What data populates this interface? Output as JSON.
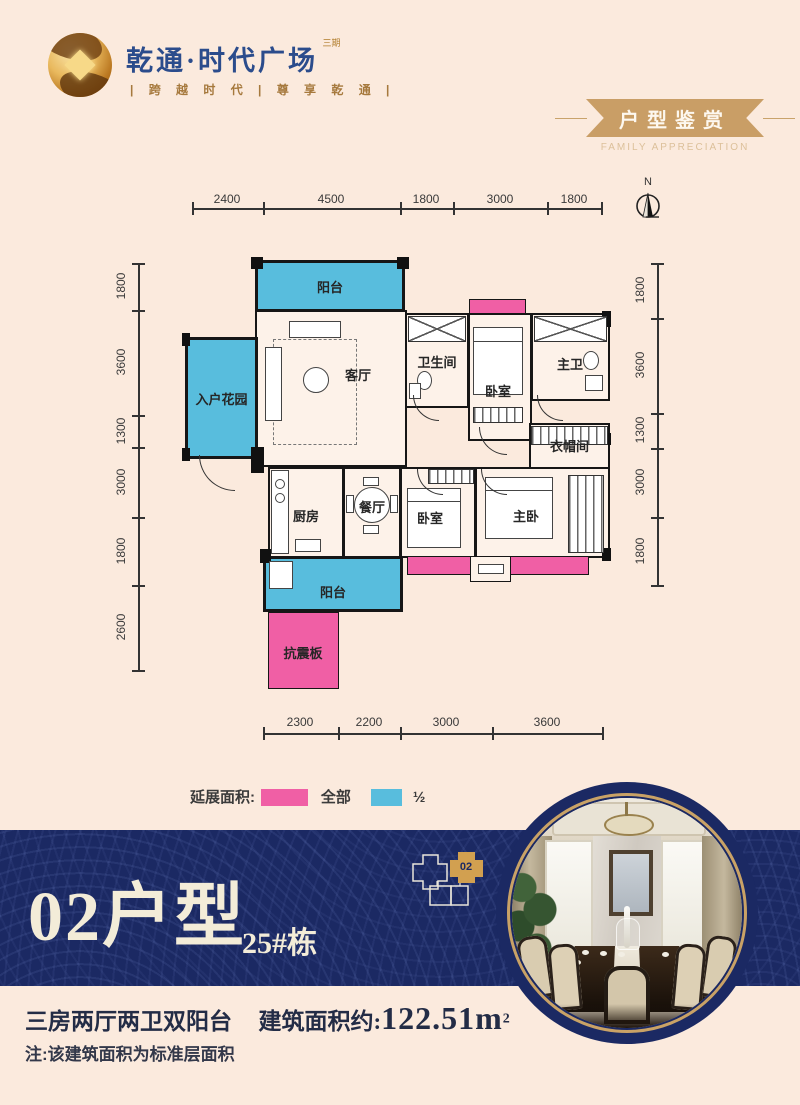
{
  "header": {
    "brand": {
      "name": "乾通·时代广场",
      "phase": "三期",
      "tagline": "| 跨 越 时 代 | 尊 享 乾 通 |"
    },
    "badge": {
      "title": "户型鉴赏",
      "subtitle": "FAMILY APPRECIATION"
    }
  },
  "plan": {
    "north": "N",
    "dims": {
      "top": [
        "2400",
        "4500",
        "1800",
        "3000",
        "1800"
      ],
      "left": [
        "1800",
        "3600",
        "1300",
        "3000",
        "1800",
        "2600"
      ],
      "right": [
        "1800",
        "3600",
        "1300",
        "3000",
        "1800"
      ],
      "bottom": [
        "2300",
        "2200",
        "3000",
        "3600"
      ]
    },
    "rooms": {
      "balcony_top": "阳台",
      "living": "客厅",
      "garden": "入户花园",
      "bathroom": "卫生间",
      "bedroom_top": "卧室",
      "master_bath": "主卫",
      "cloakroom": "衣帽间",
      "kitchen": "厨房",
      "dining": "餐厅",
      "bedroom_bottom": "卧室",
      "master_bedroom": "主卧",
      "balcony_bottom": "阳台",
      "seismic": "抗震板"
    }
  },
  "legend": {
    "label": "延展面积:",
    "full_label": "全部",
    "half_label": "½",
    "full_color": "#f05fa5",
    "half_color": "#58bddd"
  },
  "unit": {
    "number": "02户型",
    "building": "25#栋",
    "keyplan_tag": "02"
  },
  "footer": {
    "layout": "三房两厅两卫双阳台",
    "area_label": "建筑面积约:",
    "area_value": "122.51m",
    "area_exp": "2",
    "note": "注:该建筑面积为标准层面积"
  },
  "colors": {
    "background": "#fbeadd",
    "navy_band": "#1b2963",
    "gold": "#c99e66",
    "brand_blue": "#2b4c8c",
    "accent_pink": "#f05fa5",
    "accent_blue": "#58bddd"
  }
}
